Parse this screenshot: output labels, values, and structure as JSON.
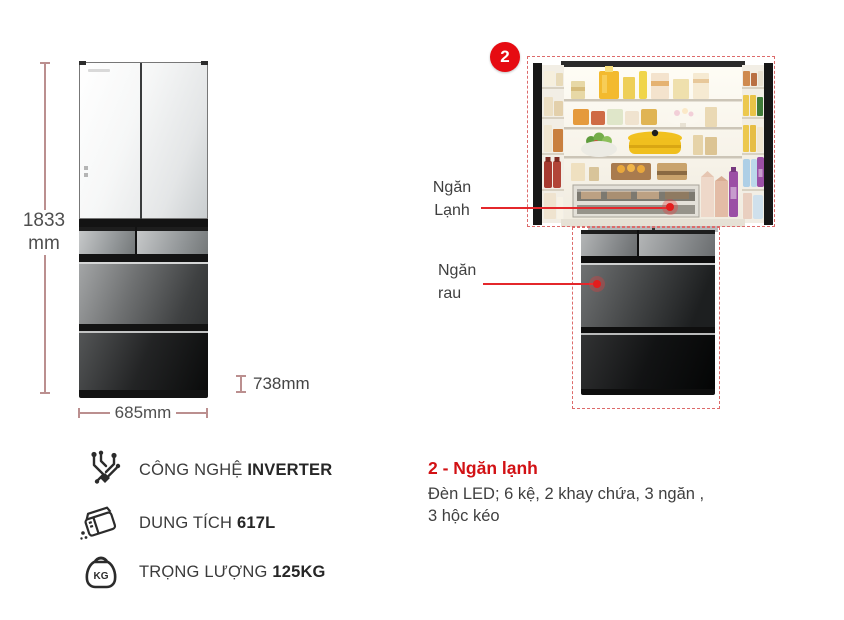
{
  "dimensions": {
    "height_value": "1833",
    "height_unit": "mm",
    "width": "685mm",
    "depth": "738mm"
  },
  "hotspot": {
    "badge": "2",
    "cold": {
      "line1": "Ngăn",
      "line2": "Lạnh"
    },
    "veg": {
      "line1": "Ngăn",
      "line2": "rau"
    }
  },
  "specs": [
    {
      "icon": "inverter-circuit-icon",
      "prefix": "CÔNG NGHỆ ",
      "value": "INVERTER"
    },
    {
      "icon": "fridge-capacity-icon",
      "prefix": "DUNG TÍCH ",
      "value": "617L"
    },
    {
      "icon": "weight-kettlebell-icon",
      "prefix": "TRỌNG LƯỢNG ",
      "value": "125KG",
      "icon_label": "KG"
    }
  ],
  "callout": {
    "title": "2 - Ngăn lạnh",
    "line1": "Đèn LED; 6 kệ, 2 khay chứa, 3 ngăn ,",
    "line2": "3 hộc kéo"
  },
  "colors": {
    "accent_red": "#e60b12",
    "connector_red": "#e4272b",
    "dashed_red": "#dd6b6b",
    "dimension_line": "#bb8f8f",
    "text_gray": "#3d3d3d"
  }
}
